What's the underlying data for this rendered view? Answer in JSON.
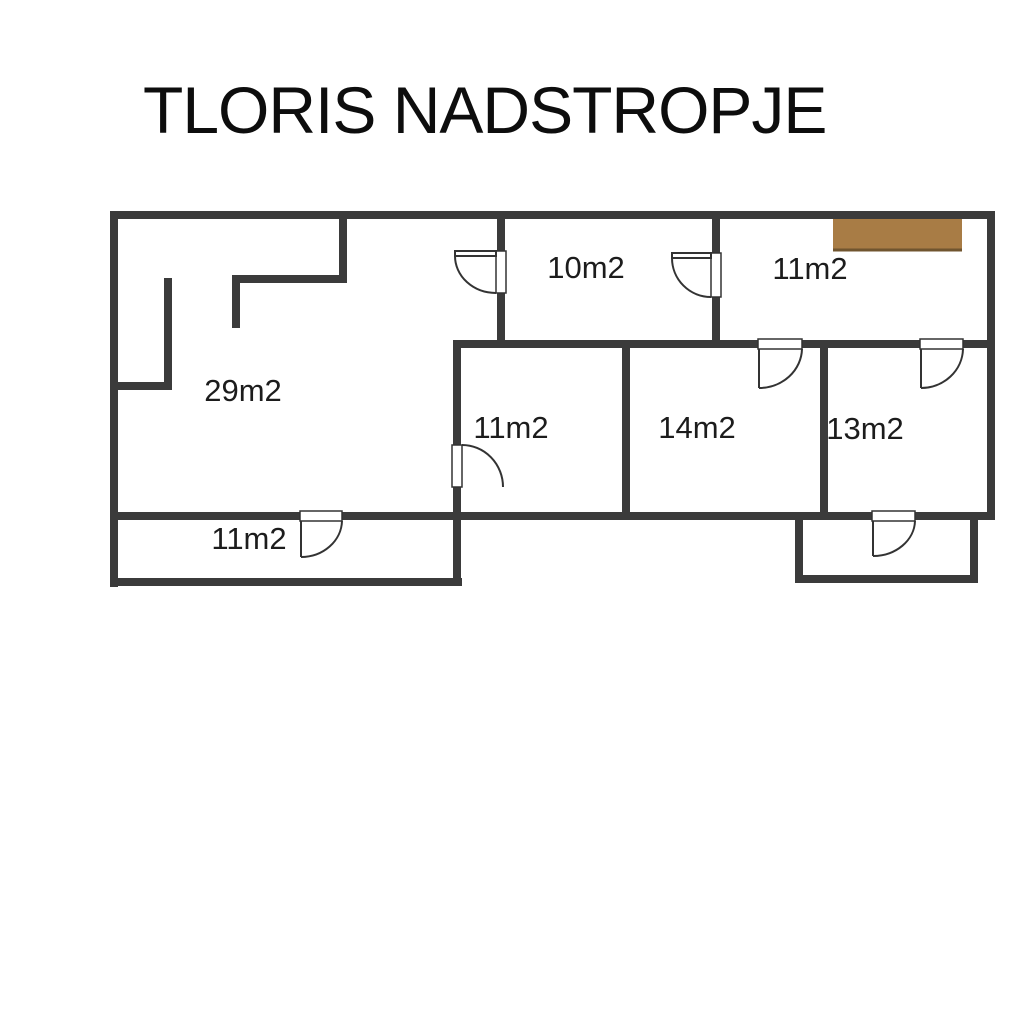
{
  "title": "TLORIS NADSTROPJE",
  "rooms": [
    {
      "name": "large-room",
      "label": "29m2"
    },
    {
      "name": "room-10-top-middle",
      "label": "10m2"
    },
    {
      "name": "room-11-top-right",
      "label": "11m2"
    },
    {
      "name": "room-11-middle",
      "label": "11m2"
    },
    {
      "name": "room-14",
      "label": "14m2"
    },
    {
      "name": "room-13",
      "label": "13m2"
    },
    {
      "name": "room-11-bottom",
      "label": "11m2"
    }
  ],
  "doors": [
    "door-29m2-to-10m2",
    "door-10m2-to-11m2-top-right",
    "door-29m2-to-11m2-middle",
    "door-29m2-to-11m2-bottom",
    "door-11m2-top-right-to-14m2",
    "door-11m2-top-right-to-13m2",
    "door-13m2-to-balcony"
  ],
  "colors": {
    "background": "#ffffff",
    "wall": "#3b3b3b",
    "door_line": "#333333",
    "opening_fill": "#ffffff",
    "closet": "#a87c45",
    "closet_edge": "#70552f",
    "text": "#1c1c1c",
    "title": "#0d0d0d"
  }
}
